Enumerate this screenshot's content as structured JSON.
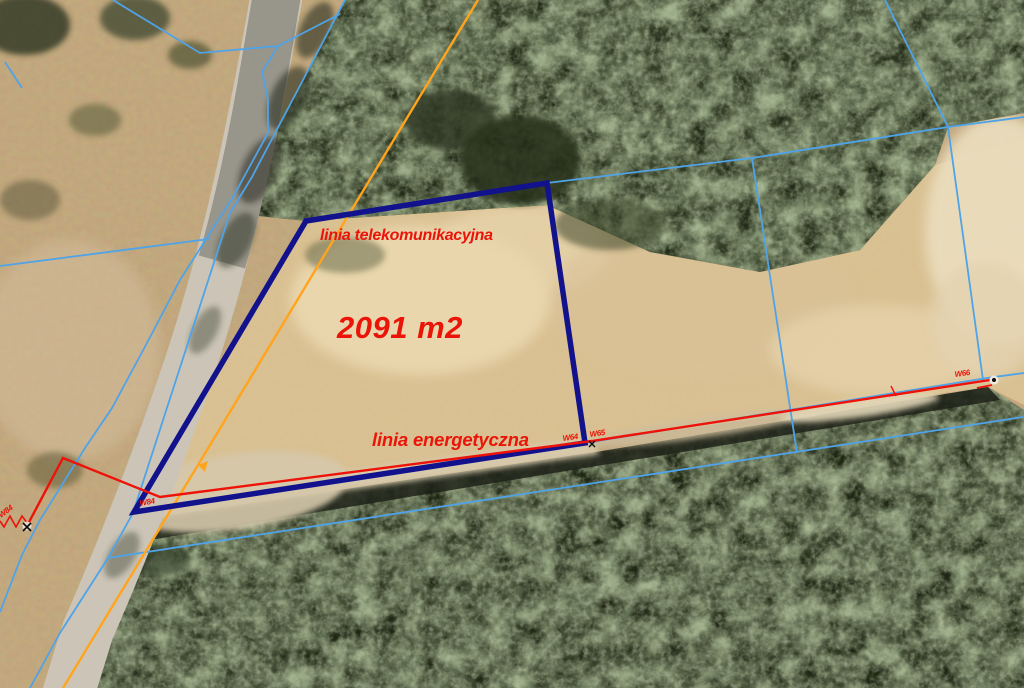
{
  "map": {
    "area_label": "2091 m2",
    "telecom_label": "linia telekomunikacyjna",
    "power_label": "linia energetyczna",
    "pole_labels": {
      "far_left": "W84",
      "crossing": "W84",
      "corner_a": "W64",
      "corner_b": "W65",
      "east_end": "W66"
    },
    "colors": {
      "parcel_outline": "#12128C",
      "cadastral_line": "#4FA3E8",
      "power_line": "#EE1208",
      "telecom_line": "#FFA41C",
      "annotation_text": "#EA1408"
    }
  }
}
